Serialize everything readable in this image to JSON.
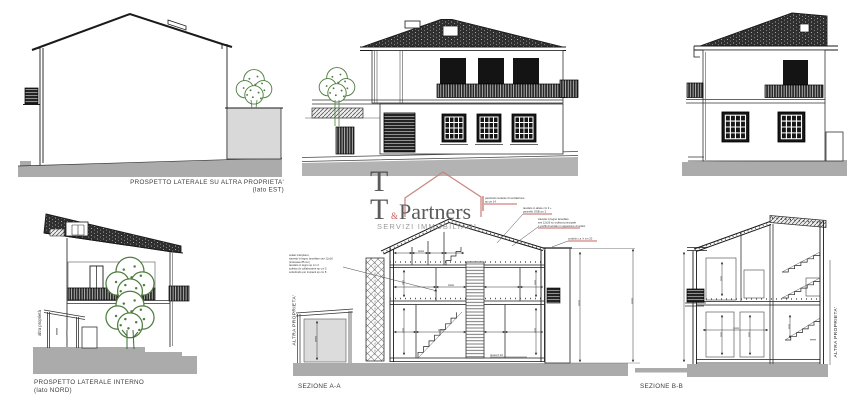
{
  "colors": {
    "ink": "#1a1a1a",
    "ground_grey": "#ababab",
    "roof_dark": "#2f2f2f",
    "tree_green": "#4e7d3e",
    "logo_red": "#c0504d",
    "logo_red_light": "#c77d74",
    "logo_grey": "#4a4a4a",
    "logo_subtitle_grey": "#8f8f8f",
    "annotation_red": "#b03030"
  },
  "watermark": {
    "t_top": "T",
    "t_bottom": "T",
    "ampersand": "&",
    "partners": "Partners",
    "subtitle": "SERVIZI IMMOBILIARI"
  },
  "panels": {
    "east": {
      "title": "PROSPETTO LATERALE SU ALTRA PROPRIETA'",
      "subtitle": "(lato EST)"
    },
    "north": {
      "title": "PROSPETTO LATERALE INTERNO",
      "subtitle": "(lato NORD)",
      "boundary_label": "altra proprietà"
    },
    "section_a": {
      "title": "SEZIONE A-A",
      "boundary_label": "ALTRA PROPRIETA'",
      "ann_left": [
        "solaio interpiano:",
        "travetto in legno lamellare sez 12x16",
        "(interasse 85 cm)",
        "tavolato in legno sp cm 3",
        "soletta cls collaborante sp cm 5",
        "sottofondo per impianti sp cm 8"
      ],
      "ann_vent": [
        "pacchetto isolante di ventilazione",
        "sp cm 14"
      ],
      "ann_abete": [
        "tavolato in abete cm 3 +",
        "pannello OSB cm 2"
      ],
      "ann_travetto": [
        "travetto in legno lamellare",
        "sez 12x26 su orditura principale",
        "e profili di acciaio in appesione di solaio"
      ],
      "ann_cordolo": "cordolo c.a. h cm 20",
      "ann_quota": "quota 0.10"
    },
    "section_b": {
      "title": "SEZIONE B-B",
      "boundary_label": "ALTRA PROPRIETA'"
    }
  }
}
